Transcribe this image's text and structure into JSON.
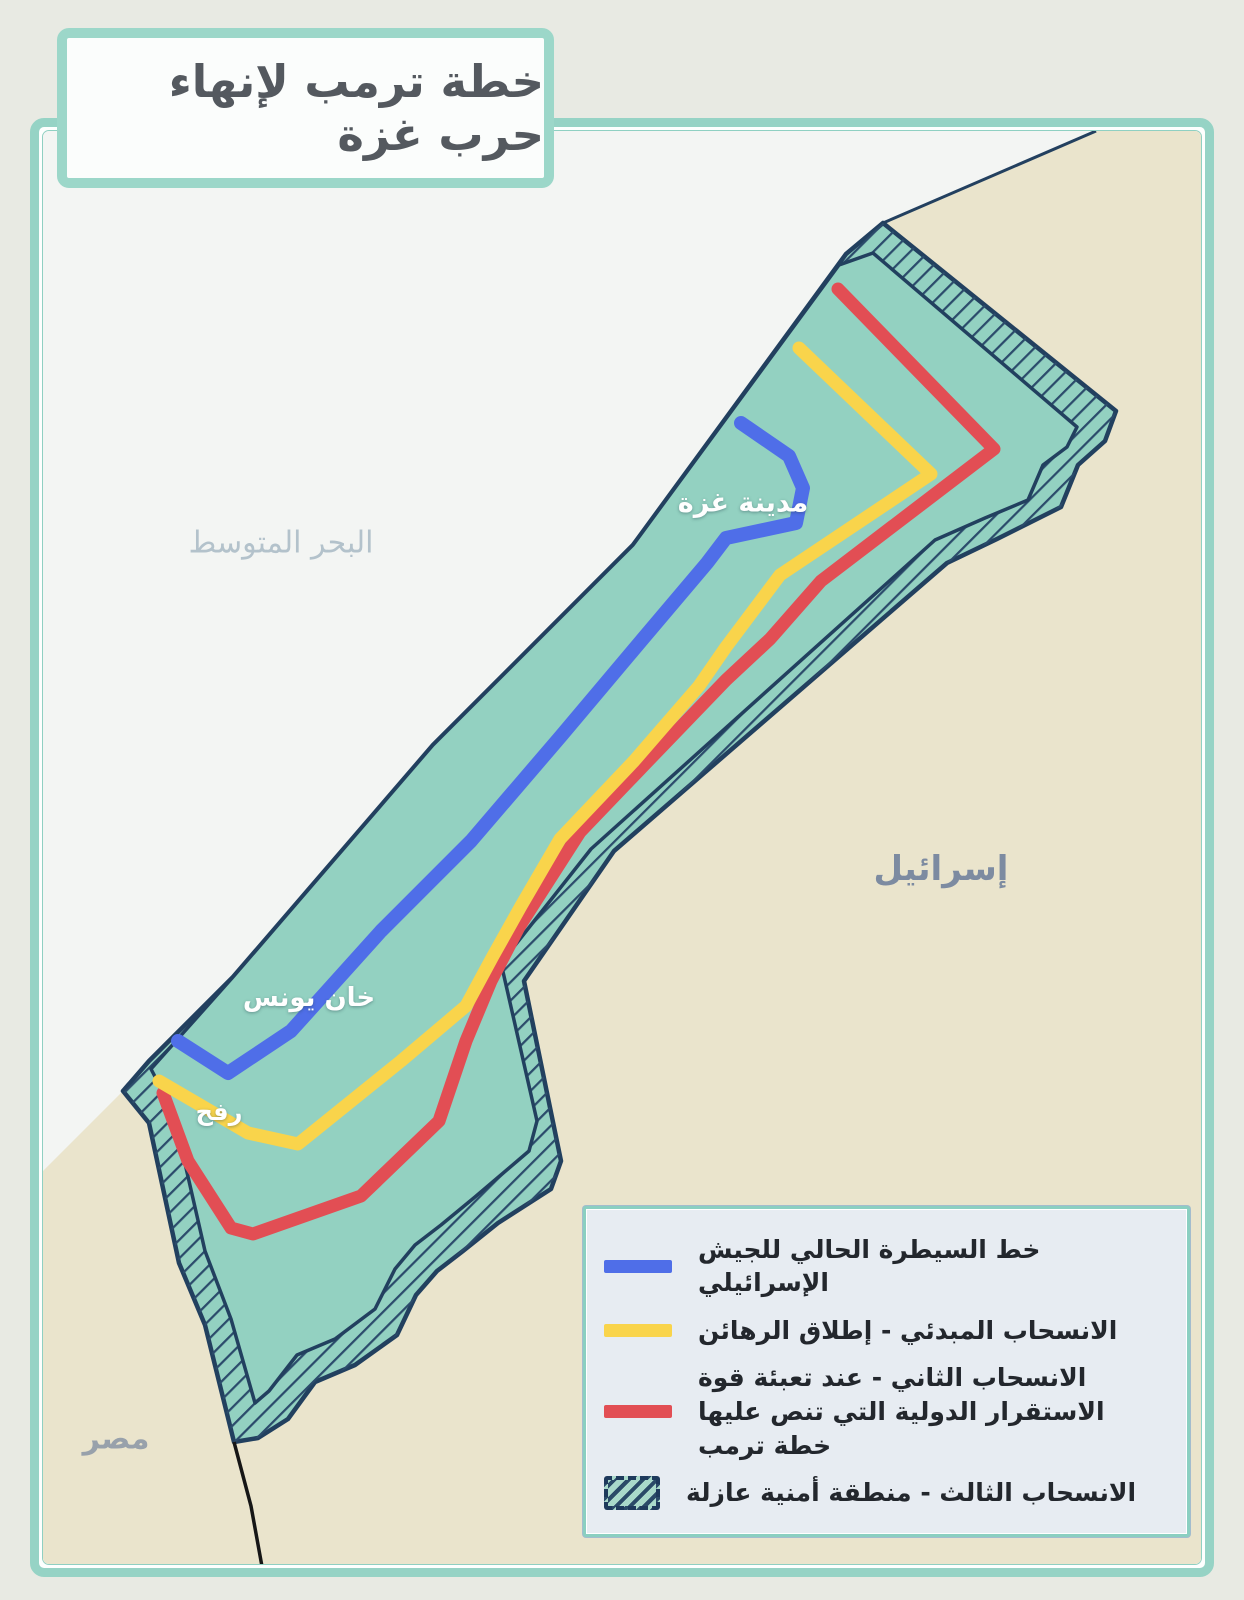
{
  "title": "خطة ترمب لإنهاء حرب غزة",
  "map": {
    "labels": {
      "sea": "البحر المتوسط",
      "israel": "إسرائيل",
      "egypt": "مصر",
      "gaza_city": "مدينة غزة",
      "khan_younis": "خان يونس",
      "rafah": "رفح"
    }
  },
  "legend": {
    "items": [
      {
        "key": "current-israeli-control-line",
        "swatch": "blue-line",
        "color": "#4f6ee8",
        "label": "خط السيطرة الحالي للجيش الإسرائيلي"
      },
      {
        "key": "initial-withdrawal-hostage-release",
        "swatch": "yellow-line",
        "color": "#f9d44b",
        "label": "الانسحاب المبدئي - إطلاق الرهائن"
      },
      {
        "key": "second-withdrawal-stabilization-force",
        "swatch": "red-line",
        "color": "#e24e54",
        "label": "الانسحاب الثاني - عند تعبئة قوة الاستقرار الدولية التي تنص عليها خطة ترمب"
      },
      {
        "key": "third-withdrawal-buffer-zone",
        "swatch": "hatched-area",
        "color": "#24425f",
        "label": "الانسحاب الثالث - منطقة أمنية عازلة"
      }
    ]
  },
  "colors": {
    "frame_teal": "#96d3c5",
    "strip_fill": "#93d1c1",
    "border_navy": "#22405f",
    "hatch_navy": "#2b4b6b",
    "sea": "#f3f5f3",
    "land_beige": "#eae4cc",
    "blue_line": "#4f6ee8",
    "yellow_line": "#f9d44b",
    "red_line": "#e24e54"
  }
}
